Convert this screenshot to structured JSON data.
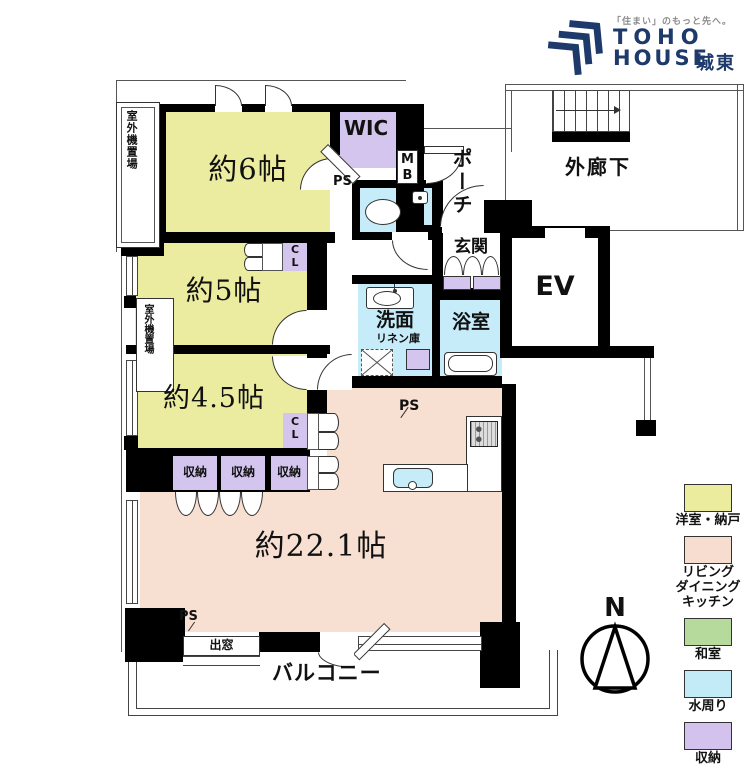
{
  "logo": {
    "tagline": "「住まい」のもっと先へ。",
    "name_line1": "TOHO",
    "name_line2": "HOUSE",
    "region": "城東"
  },
  "rooms": {
    "bedroom_6": "約6帖",
    "bedroom_5": "約5帖",
    "bedroom_4_5": "約4.5帖",
    "ldk": "約22.1帖",
    "wic": "WIC",
    "entrance": "玄関",
    "porch": "ポーチ",
    "corridor": "外廊下",
    "elevator": "EV",
    "washroom": "洗面",
    "linen": "リネン庫",
    "bathroom": "浴室",
    "storage": "収納",
    "bay_window": "出窓",
    "balcony": "バルコニー",
    "outdoor_unit": "室外機置場",
    "outdoor_unit_l1": "室外機",
    "outdoor_unit_l2": "置場",
    "pipe_space": "PS",
    "meter_box": [
      "M",
      "B"
    ],
    "closet": [
      "C",
      "L"
    ]
  },
  "compass": {
    "north": "N"
  },
  "legend": {
    "items": [
      {
        "label": "洋室・納戸",
        "color": "#ecec9e"
      },
      {
        "label": "リビング\nダイニング\nキッチン",
        "color": "#f6ddcf"
      },
      {
        "label": "和室",
        "color": "#b5da9b"
      },
      {
        "label": "水周り",
        "color": "#c2eaf7"
      },
      {
        "label": "収納",
        "color": "#d2c2ed"
      }
    ]
  },
  "colors": {
    "wall": "#000000",
    "western_room": "#ececa0",
    "ldk": "#f7dfd2",
    "water": "#c5ecf8",
    "storage": "#d4c5ee",
    "brand_navy": "#1d3a6a",
    "tagline_gray": "#8a8a8a"
  }
}
